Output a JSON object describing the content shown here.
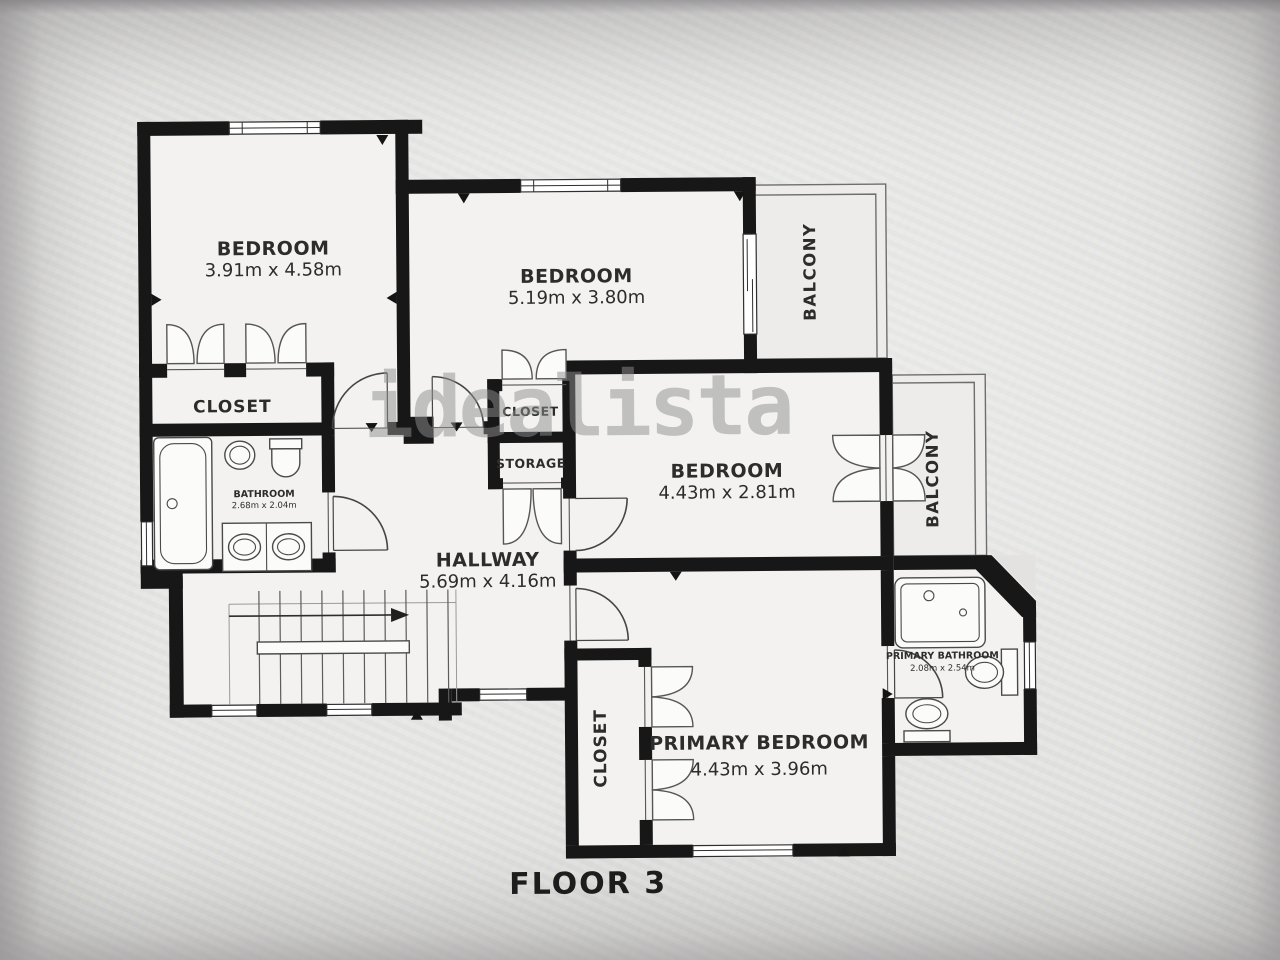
{
  "floor_label": "FLOOR 3",
  "watermark": "idealista",
  "rooms": {
    "bedroom_top_left": {
      "name": "BEDROOM",
      "dims": "3.91m x 4.58m"
    },
    "bedroom_top_middle": {
      "name": "BEDROOM",
      "dims": "5.19m x 3.80m"
    },
    "bedroom_middle_right": {
      "name": "BEDROOM",
      "dims": "4.43m x 2.81m"
    },
    "primary_bedroom": {
      "name": "PRIMARY BEDROOM",
      "dims": "4.43m x 3.96m"
    },
    "hallway": {
      "name": "HALLWAY",
      "dims": "5.69m x 4.16m"
    },
    "bathroom": {
      "name": "BATHROOM",
      "dims": "2.68m x 2.04m"
    },
    "primary_bathroom": {
      "name": "PRIMARY BATHROOM",
      "dims": "2.08m x 2.54m"
    },
    "closet_bedroom_top_left": {
      "name": "CLOSET"
    },
    "closet_middle": {
      "name": "CLOSET"
    },
    "storage": {
      "name": "STORAGE"
    },
    "closet_primary": {
      "name": "CLOSET"
    },
    "balcony_top": {
      "name": "BALCONY"
    },
    "balcony_right": {
      "name": "BALCONY"
    }
  },
  "colors": {
    "wall": "#171717",
    "floor": "#f3f2f0",
    "balcony": "#edecea",
    "text": "#2c2c2c",
    "watermark": "#8f8f8f"
  }
}
